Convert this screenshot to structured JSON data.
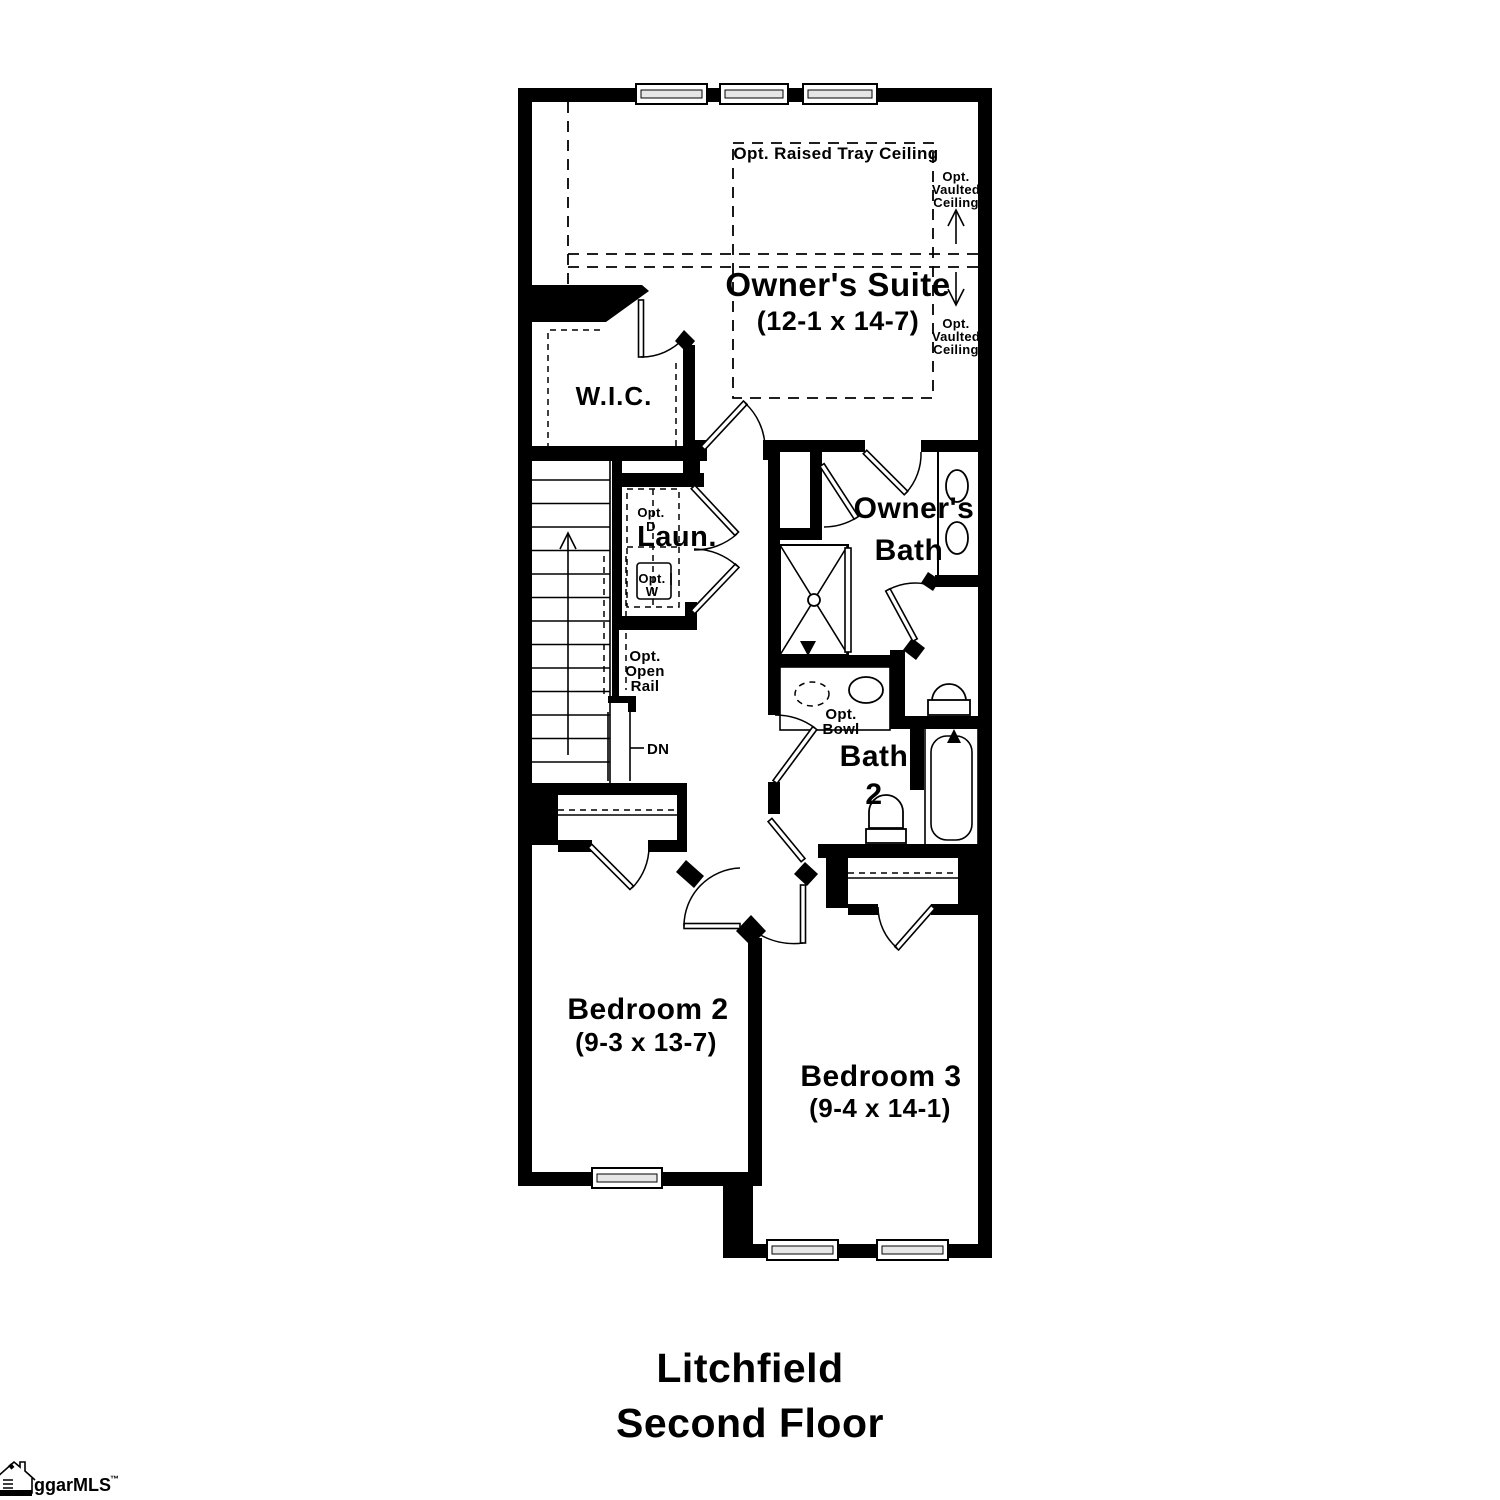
{
  "title": {
    "name": "Litchfield",
    "floor": "Second Floor"
  },
  "logo": {
    "brand": "ggarMLS",
    "trademark": "™"
  },
  "rooms": {
    "owners_suite": {
      "name": "Owner's Suite",
      "dims": "(12-1 x 14-7)"
    },
    "wic": {
      "name": "W.I.C."
    },
    "laundry": {
      "name": "Laun."
    },
    "owners_bath": {
      "line1": "Owner's",
      "line2": "Bath"
    },
    "bath2": {
      "line1": "Bath",
      "line2": "2"
    },
    "bedroom2": {
      "name": "Bedroom 2",
      "dims": "(9-3 x 13-7)"
    },
    "bedroom3": {
      "name": "Bedroom 3",
      "dims": "(9-4 x 14-1)"
    }
  },
  "annotations": {
    "tray_ceiling": "Opt. Raised Tray Ceiling",
    "vaulted_upper": {
      "line1": "Opt.",
      "line2": "Vaulted",
      "line3": "Ceiling"
    },
    "vaulted_lower": {
      "line1": "Opt.",
      "line2": "Vaulted",
      "line3": "Ceiling"
    },
    "open_rail": {
      "line1": "Opt.",
      "line2": "Open",
      "line3": "Rail"
    },
    "down": "DN",
    "opt_dryer": {
      "line1": "Opt.",
      "line2": "D"
    },
    "opt_washer": {
      "line1": "Opt.",
      "line2": "W"
    },
    "opt_bowl": {
      "line1": "Opt.",
      "line2": "Bowl"
    }
  },
  "colors": {
    "wall": "#000000",
    "background": "#ffffff",
    "window_fill": "#e6e6e6"
  }
}
